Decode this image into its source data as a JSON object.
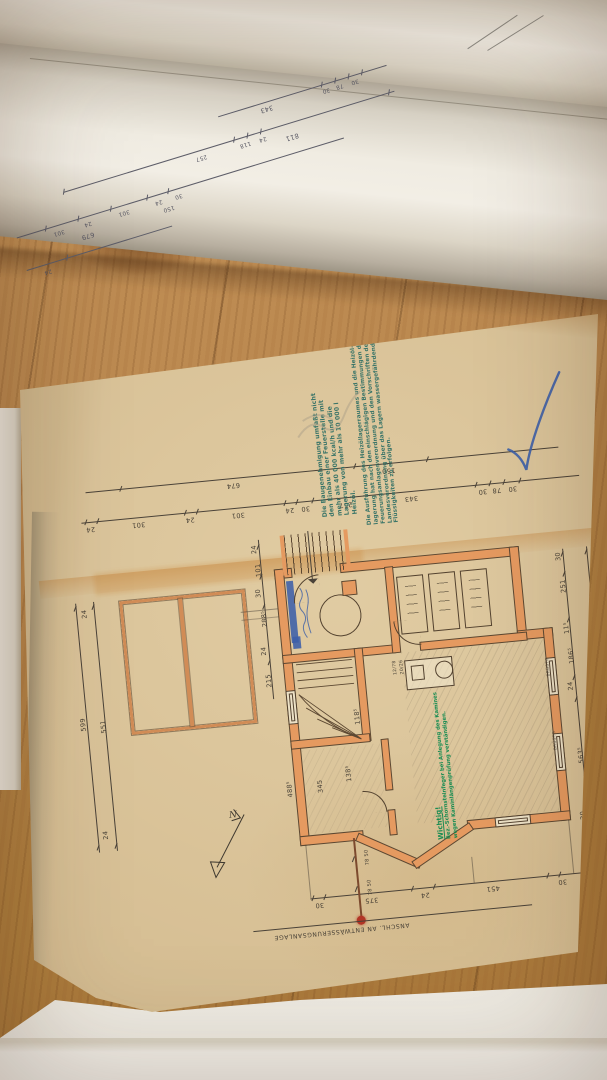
{
  "colors": {
    "paper_tan": "#d5bd92",
    "wall_orange": "#e59a60",
    "stamp_teal": "#2d6e64",
    "stamp_green": "#0f8a4f",
    "ink_blue": "#3c5fa8",
    "red_dot": "#b13526",
    "ink": "#4a4238"
  },
  "roll": {
    "row1": [
      "343",
      "30",
      "78",
      "30"
    ],
    "row2": [
      "257",
      "118",
      "24",
      "811"
    ],
    "row3": [
      "301",
      "24",
      "301",
      "24",
      "30",
      "150",
      "679"
    ],
    "row4": [
      "24"
    ]
  },
  "sheet": {
    "upper_chain": [
      "674",
      "150"
    ],
    "lower_chain": [
      "24",
      "301",
      "24",
      "301",
      "24",
      "30",
      "257",
      "343",
      "30",
      "78",
      "30"
    ],
    "permit_stamp": {
      "lines": [
        "Die Baugenehmigung umfaßt nicht",
        "den Einbau einer Feuerstelle mit",
        "mehr als 40 000 kcal/h und die",
        "Lagerung von mehr als 10 000 l",
        "Heizöl."
      ]
    },
    "regulation_stamp": {
      "lines": [
        "Die Ausführung des Heizöllagerraumes und die Heizöl-",
        "lagerung hat nach den einschlägigen Bestimmungen der",
        "Feuerungsanlagenverordnung und den Vorschriften der",
        "Landesverordnung über das Lagern wassergefährdender",
        "Flüssigkeiten zu erfolgen."
      ]
    },
    "important_stamp": {
      "title": "Wichtig!",
      "lines": [
        "Bez.-Schornsteinfeger bei Anlegung des Kamines",
        "wegen Kaminlängenprüfung verständigen."
      ]
    },
    "plan": {
      "left_chain": [
        "24",
        "599",
        "551",
        "24"
      ],
      "top_chain": [
        "24",
        "101",
        "30",
        "288⁵",
        "24",
        "215"
      ],
      "right_chain": [
        "30",
        "251",
        "11⁵",
        "186⁵",
        "24",
        "563⁵",
        "30",
        "69⁵",
        "11⁵"
      ],
      "right_total": "1100",
      "bottom_chain": [
        "30",
        "375",
        "24",
        "451",
        "30"
      ],
      "room_dims": [
        "138⁵",
        "118⁵",
        "488⁵",
        "345"
      ],
      "window_label": "BRÜSTG",
      "appliance_note_1": "12/78",
      "appliance_note_2": "20/26",
      "north_label": "N",
      "drain_label": "ANSCHL. AN ENTWÄSSERUNGSANLAGE",
      "drain_dim_1": "78 50",
      "drain_dim_2": "78 50"
    }
  }
}
